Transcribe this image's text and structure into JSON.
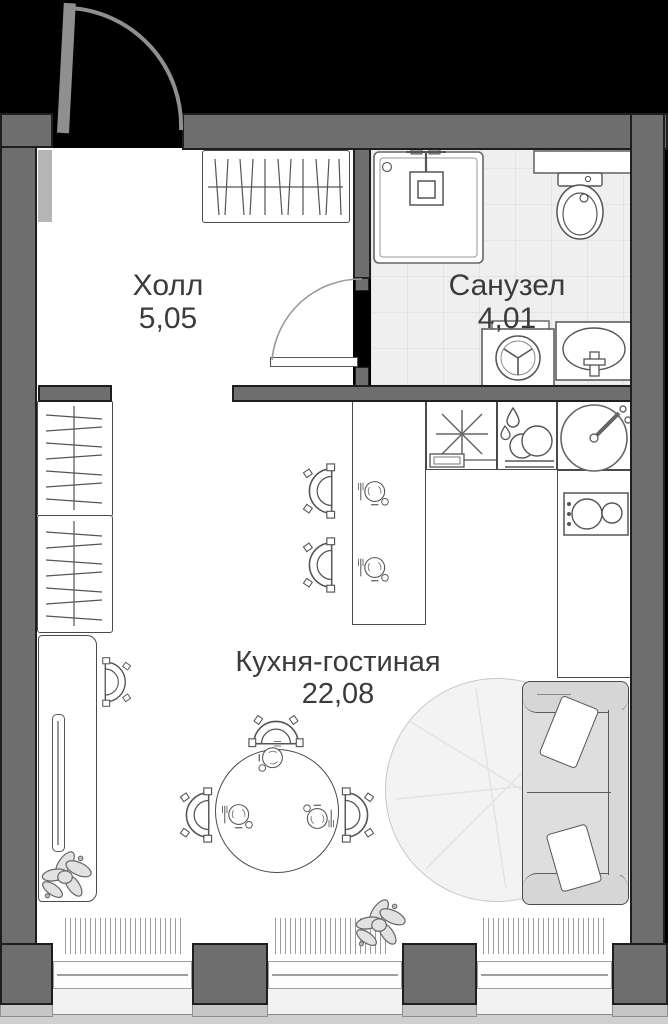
{
  "plan_title": "studio apartment floor plan",
  "rooms": [
    {
      "id": "hall",
      "label": "Холл",
      "area": "5,05"
    },
    {
      "id": "bathroom",
      "label": "Санузел",
      "area": "4,01"
    },
    {
      "id": "kitchen-living",
      "label": "Кухня-гостиная",
      "area": "22,08"
    }
  ],
  "colors": {
    "background": "#000000",
    "wall": "#6e6e6e",
    "wall_outline": "#1e1e1e",
    "floor": "#ffffff",
    "bathroom_floor": "#efefef",
    "sofa_fill": "#dedede",
    "carpet_fill": "#f3f3f3",
    "text": "#3b3b3b"
  },
  "fixtures": [
    "entry-door",
    "hall-wardrobe",
    "shower",
    "toilet",
    "washing-machine",
    "bathroom-sink",
    "bathroom-door",
    "kitchen-hob",
    "dishwasher",
    "kitchen-sink",
    "stove",
    "bar-counter",
    "bar-stools",
    "place-settings",
    "dining-table",
    "dining-chairs",
    "sofa",
    "carpet",
    "wardrobe",
    "tv-console",
    "tv",
    "armchair",
    "plants",
    "windows",
    "radiators"
  ]
}
